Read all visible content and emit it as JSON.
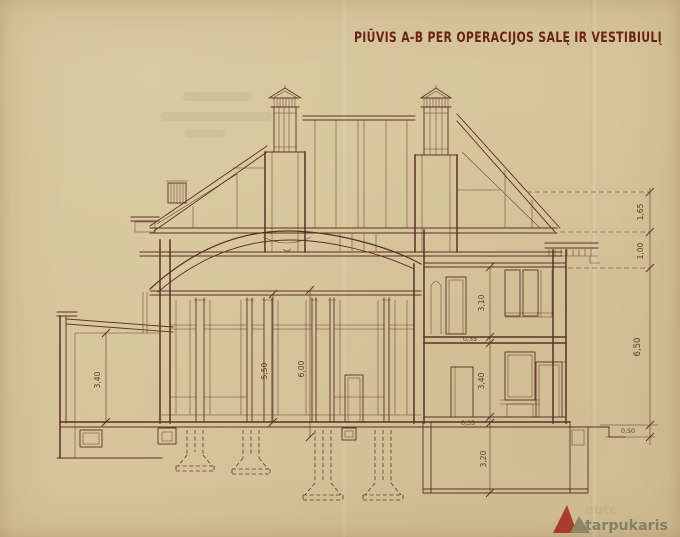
{
  "title": "PIŪVIS A-B PER OPERACIJOS SALĘ IR VESTIBIULĮ",
  "colors": {
    "paper": "#d7c49a",
    "ink": "#583225",
    "title": "#6b2318",
    "dim": "#5a3a28",
    "wm_red": "#a83c2e",
    "wm_olive": "#8e8765",
    "wm_text": "#82806b",
    "wm_text_faint": "#c2b384"
  },
  "dims": {
    "roof_upper": "1,65",
    "roof_lower": "1,00",
    "right_total": "6,50",
    "plinth": "0,50",
    "upper_room": "3,10",
    "upper_slab": "0,35",
    "lower_room": "3,40",
    "lower_slab": "0,35",
    "basement_room": "3,20",
    "hall_clear": "5,50",
    "hall_total": "6,00",
    "left_room": "3,40"
  },
  "watermark": {
    "line1": "autc",
    "line2": "tarpukaris"
  }
}
